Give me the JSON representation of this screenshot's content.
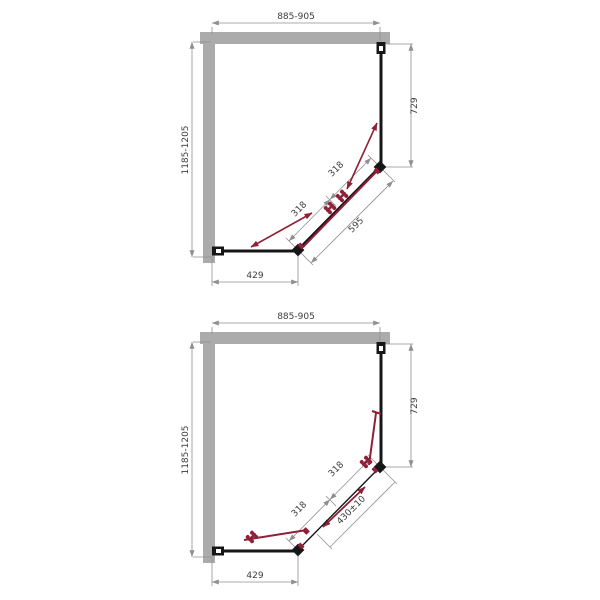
{
  "colors": {
    "wall": "#ababab",
    "frame": "#161616",
    "dim_line": "#8f8f8f",
    "dim_text": "#3c3c3c",
    "accent": "#8e2038"
  },
  "diagram_top": {
    "name": "corner-entry-shower-enclosure-doors-closed",
    "dims": {
      "width": "885-905",
      "depth": "1185-1205",
      "side_panel": "729",
      "front_panel": "429",
      "door_a": "318",
      "door_b": "318",
      "diagonal": "595"
    }
  },
  "diagram_bottom": {
    "name": "corner-entry-shower-enclosure-doors-open",
    "dims": {
      "width": "885-905",
      "depth": "1185-1205",
      "side_panel": "729",
      "front_panel": "429",
      "door_a": "318",
      "door_b": "318",
      "opening": "430±10"
    }
  }
}
